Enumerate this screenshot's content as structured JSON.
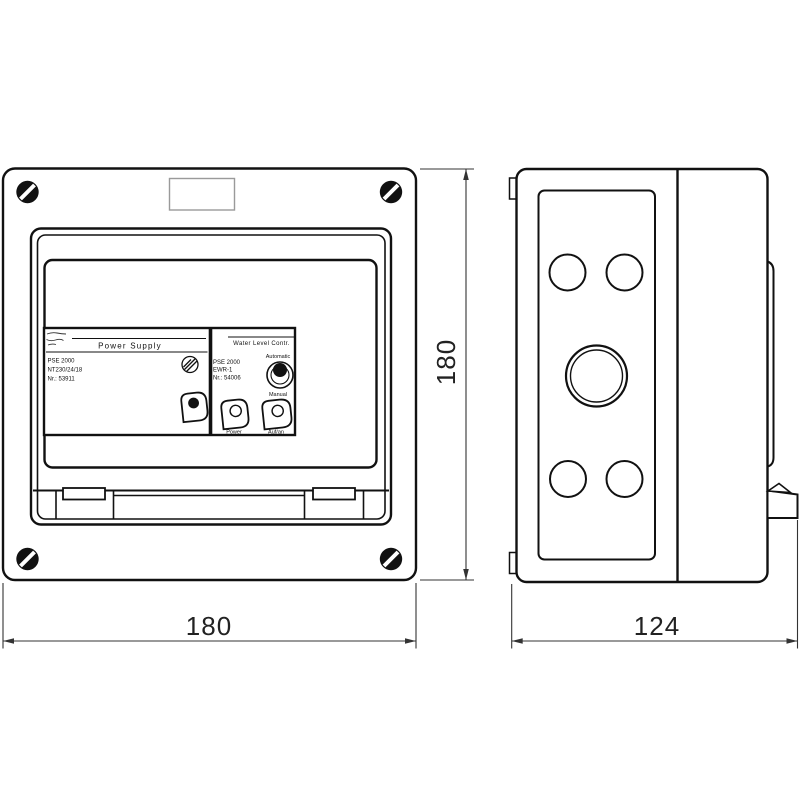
{
  "front": {
    "plate": {
      "ps": {
        "title": "Power Supply",
        "model": "PSE 2000",
        "type": "NT230/24/18",
        "serial": "Nr.: 53911"
      },
      "wl": {
        "title": "Water Level Contr.",
        "model": "PSE 2000",
        "type": "EWR-1",
        "serial": "Nr.: 54006",
        "auto": "Automatic",
        "manual": "Manual",
        "led_power": "Power",
        "led_action": "Auf/an"
      }
    }
  },
  "dims": {
    "width": "180",
    "height": "180",
    "depth": "124"
  },
  "icons": {
    "corner_screw": "slotted-screw",
    "panel_screw": "hatched-screw-head",
    "mode_knob": "rotary-knob",
    "led": "leaf-led-indicator"
  },
  "colors": {
    "line": "#111111",
    "dim_line": "#333333",
    "background": "#ffffff"
  }
}
